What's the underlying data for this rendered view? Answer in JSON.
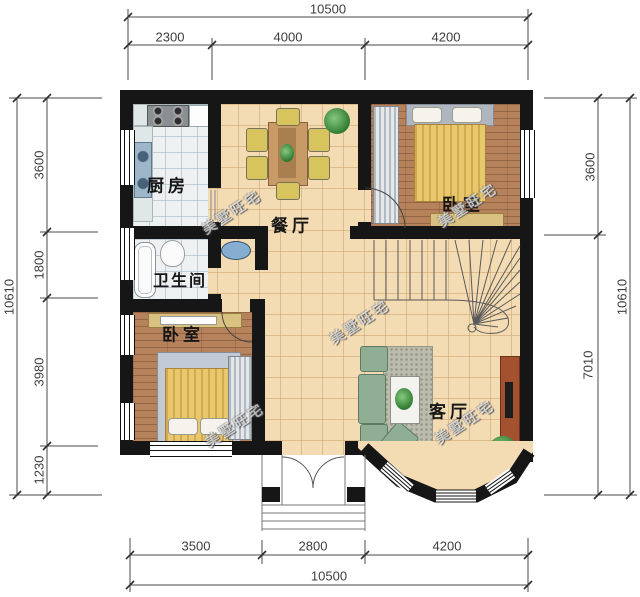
{
  "watermark": {
    "text": "美墅旺宅"
  },
  "rooms": {
    "kitchen": {
      "label": "厨房"
    },
    "dining": {
      "label": "餐厅"
    },
    "bedroom_top": {
      "label": "卧室"
    },
    "bathroom": {
      "label": "卫生间"
    },
    "bedroom_left": {
      "label": "卧室"
    },
    "living": {
      "label": "客厅"
    }
  },
  "dims": {
    "top": {
      "total": "10500",
      "segments": [
        "2300",
        "4000",
        "4200"
      ]
    },
    "left": {
      "total": "10610",
      "segments": [
        "3600",
        "1800",
        "3980",
        "1230"
      ]
    },
    "right": {
      "total": "10610",
      "segments": [
        "3600",
        "7010"
      ]
    },
    "bottom": {
      "total": "10500",
      "segments": [
        "3500",
        "2800",
        "4200"
      ]
    }
  },
  "colors": {
    "wall": "#161616",
    "tile_floor": "#f3dbb3",
    "wood_floor": "#b5825c",
    "kitchen_floor": "#eef1f2",
    "dim_line": "#4a4a4a",
    "bed_blanket": "#e9c76d",
    "sofa": "#8fae93",
    "tv_stand": "#a3512e",
    "sink": "#85aed1",
    "plant": "#2f7a30"
  }
}
